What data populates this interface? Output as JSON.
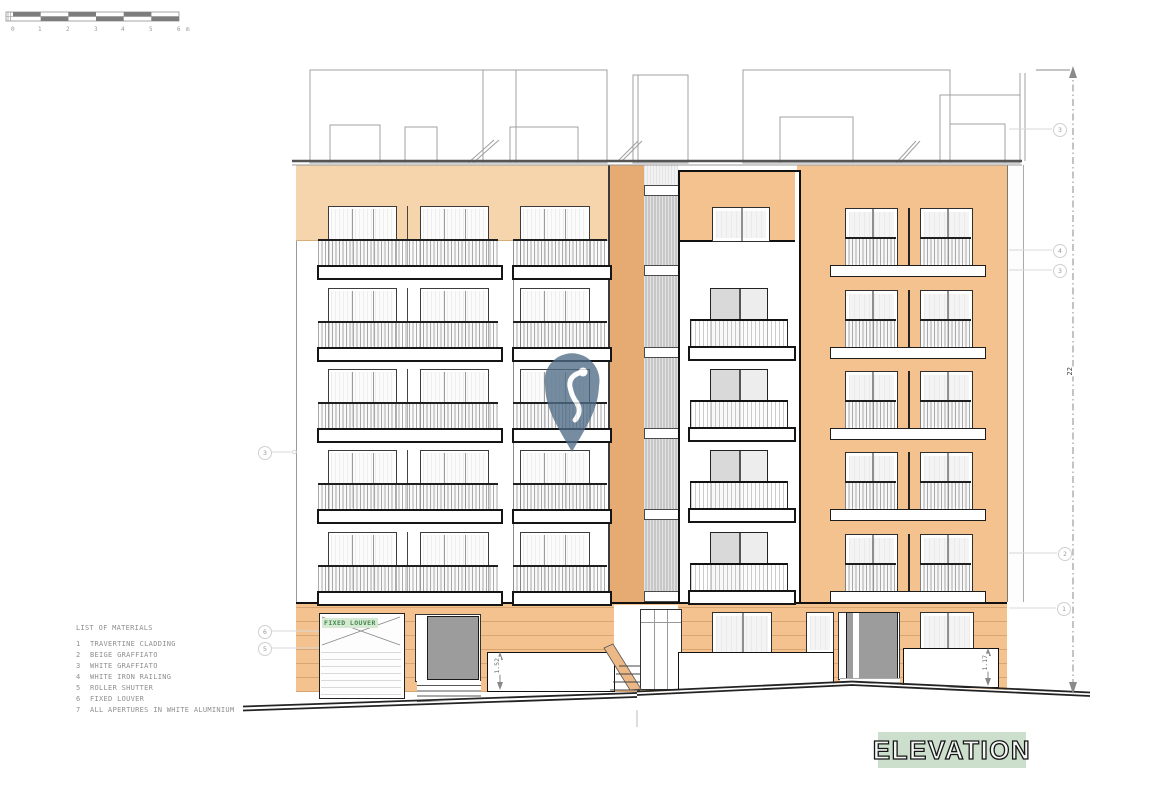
{
  "drawing": {
    "title": "ELEVATION"
  },
  "scale_bar": {
    "labels": [
      "0",
      "1",
      "2",
      "3",
      "4",
      "5",
      "6"
    ],
    "unit": "m"
  },
  "materials": {
    "title": "LIST OF MATERIALS",
    "items": [
      {
        "num": "1",
        "label": "TRAVERTINE CLADDING"
      },
      {
        "num": "2",
        "label": "BEIGE GRAFFIATO"
      },
      {
        "num": "3",
        "label": "WHITE GRAFFIATO"
      },
      {
        "num": "4",
        "label": "WHITE IRON RAILING"
      },
      {
        "num": "5",
        "label": "ROLLER SHUTTER"
      },
      {
        "num": "6",
        "label": "FIXED LOUVER"
      },
      {
        "num": "7",
        "label": "ALL APERTURES IN WHITE ALUMINIUM"
      }
    ]
  },
  "labels": {
    "fixed_louver": "FIXED LOUVER"
  },
  "dimensions": {
    "overall_height": "22",
    "parapet_left": "1.52",
    "parapet_right": "1.17"
  },
  "callouts": {
    "left": [
      {
        "label": "3"
      },
      {
        "label": "6"
      },
      {
        "label": "5"
      }
    ],
    "right": [
      {
        "label": "3"
      },
      {
        "label": "4"
      },
      {
        "label": "3"
      },
      {
        "label": "2"
      },
      {
        "label": "1"
      }
    ]
  },
  "colors": {
    "facade_orange": "#f3c28e",
    "band_light": "#f6d5ac",
    "stair_orange": "#e5ab72",
    "louver_green": "#3f8a4d",
    "louver_green_bg": "#d8e9d3",
    "title_bg": "#ccdecc",
    "watermark_pin": "#4f6c87"
  }
}
